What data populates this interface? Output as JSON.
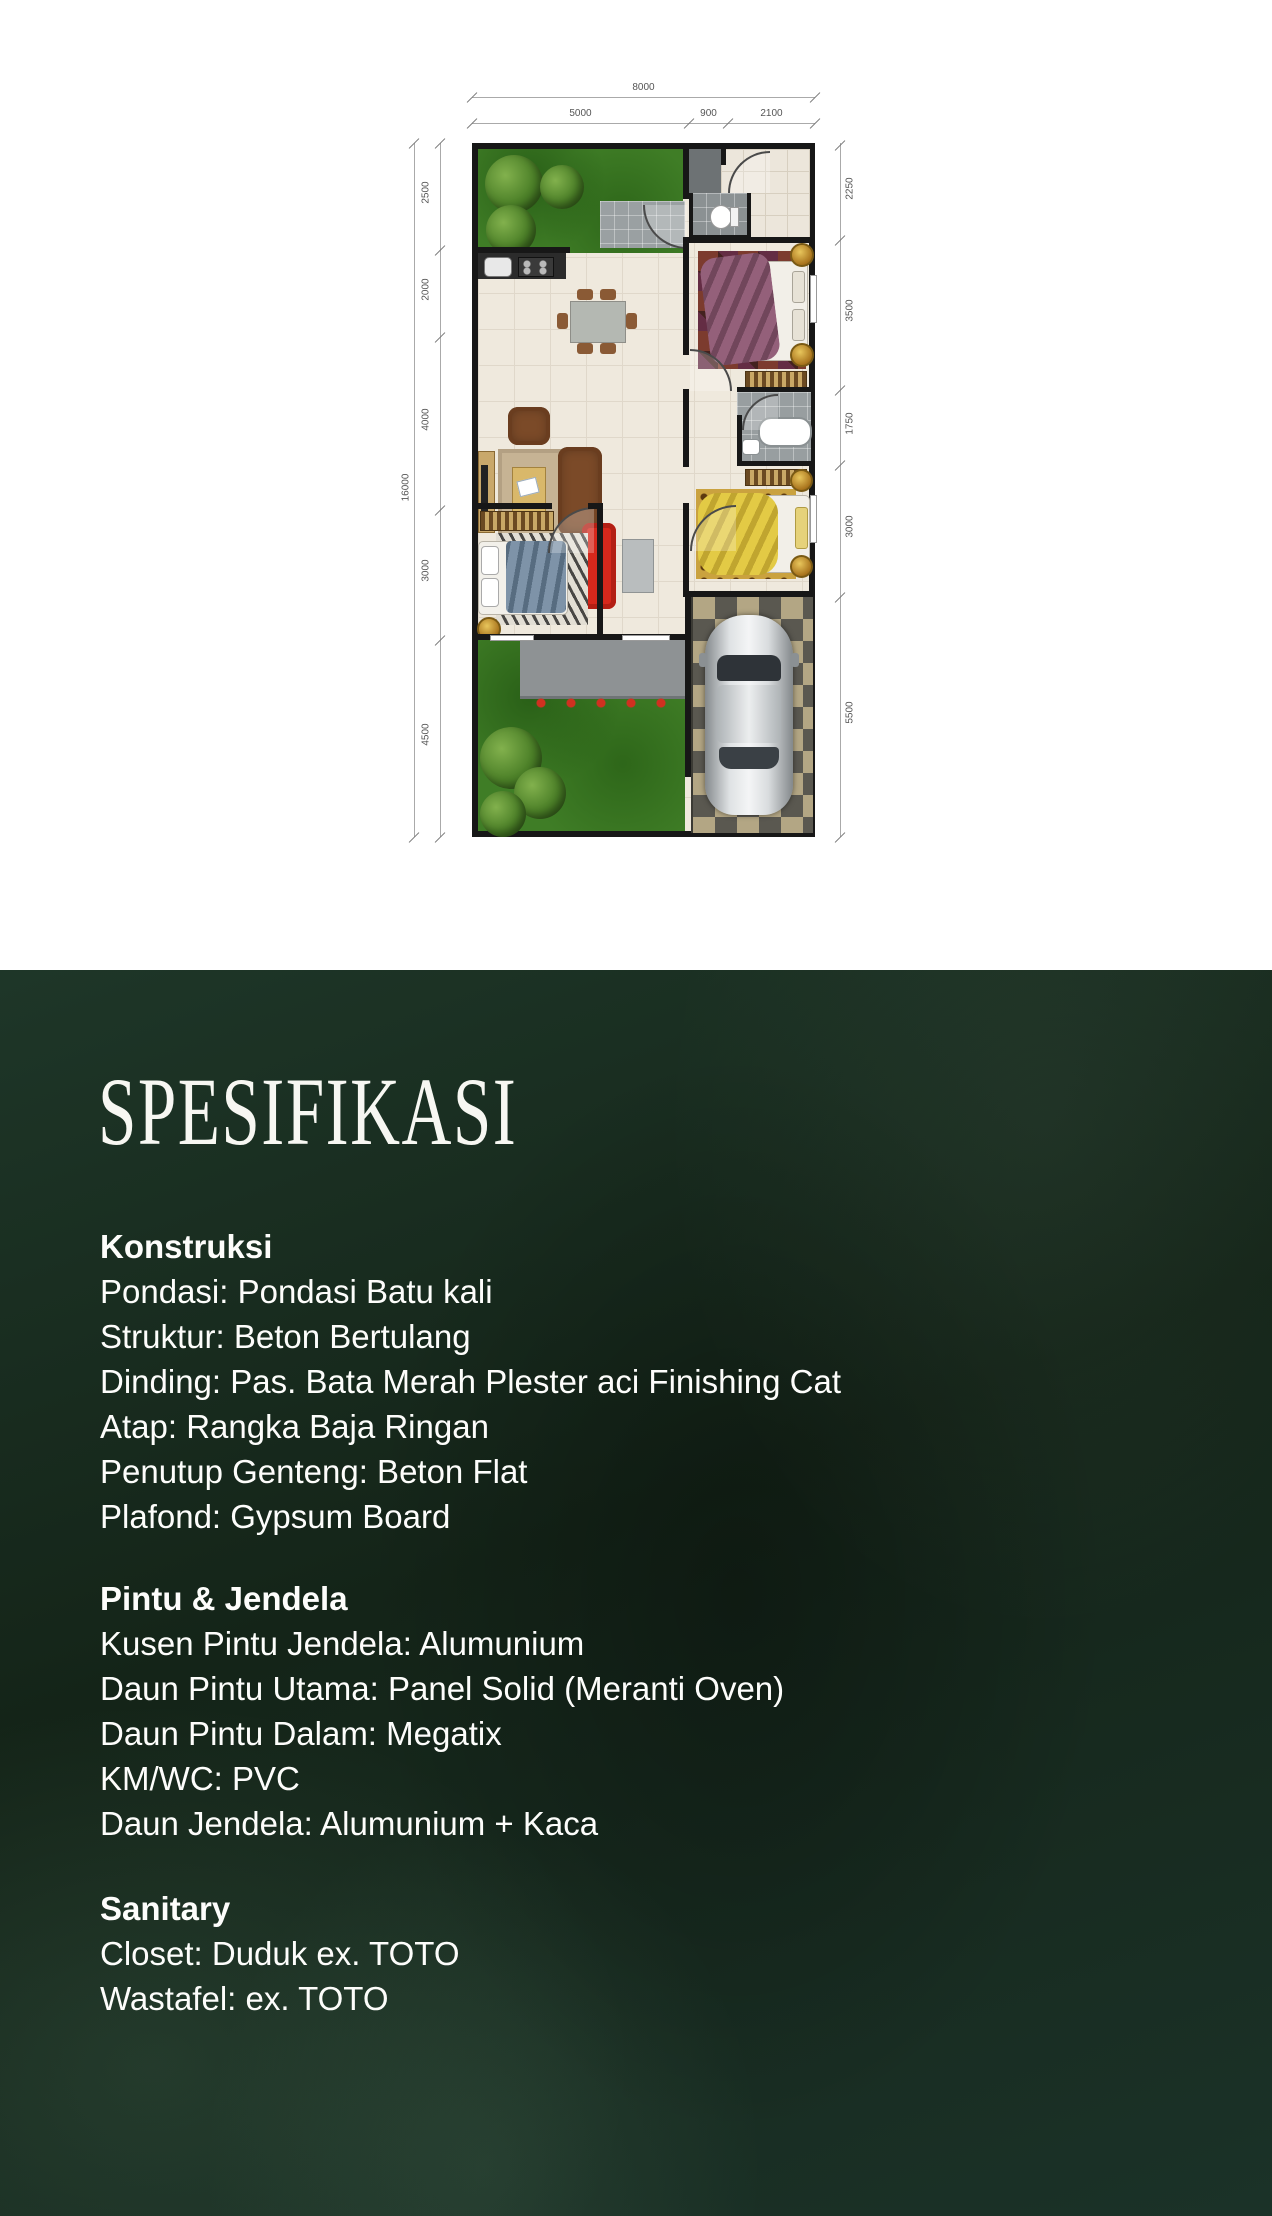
{
  "document": {
    "background": "#ffffff"
  },
  "floorplan": {
    "dims": {
      "top_overall": "8000",
      "top_segments": [
        "5000",
        "900",
        "2100"
      ],
      "left_overall": "16000",
      "left_segments": [
        "2500",
        "2000",
        "4000",
        "3000",
        "4500"
      ],
      "right_segments": [
        "2250",
        "3500",
        "1750",
        "3000",
        "5500"
      ]
    },
    "palette": {
      "grass": "#3f7d26",
      "floor": "#efe9dd",
      "wall": "#171717",
      "carport_dark": "#5a5850",
      "carport_tan": "#b3a684"
    }
  },
  "spec": {
    "title": "SPESIFIKASI",
    "text_color": "#ffffff",
    "background": "#16281d",
    "sections": [
      {
        "heading": "Konstruksi",
        "items": [
          "Pondasi: Pondasi Batu kali",
          "Struktur: Beton Bertulang",
          "Dinding: Pas. Bata Merah Plester aci Finishing Cat",
          "Atap: Rangka Baja Ringan",
          "Penutup Genteng: Beton Flat",
          "Plafond: Gypsum Board"
        ]
      },
      {
        "heading": "Pintu & Jendela",
        "items": [
          "Kusen Pintu Jendela: Alumunium",
          "Daun Pintu Utama: Panel Solid (Meranti Oven)",
          "Daun Pintu Dalam: Megatix",
          "KM/WC: PVC",
          "Daun Jendela: Alumunium + Kaca"
        ]
      },
      {
        "heading": "Sanitary",
        "items": [
          "Closet: Duduk ex. TOTO",
          "Wastafel: ex. TOTO"
        ]
      }
    ]
  }
}
